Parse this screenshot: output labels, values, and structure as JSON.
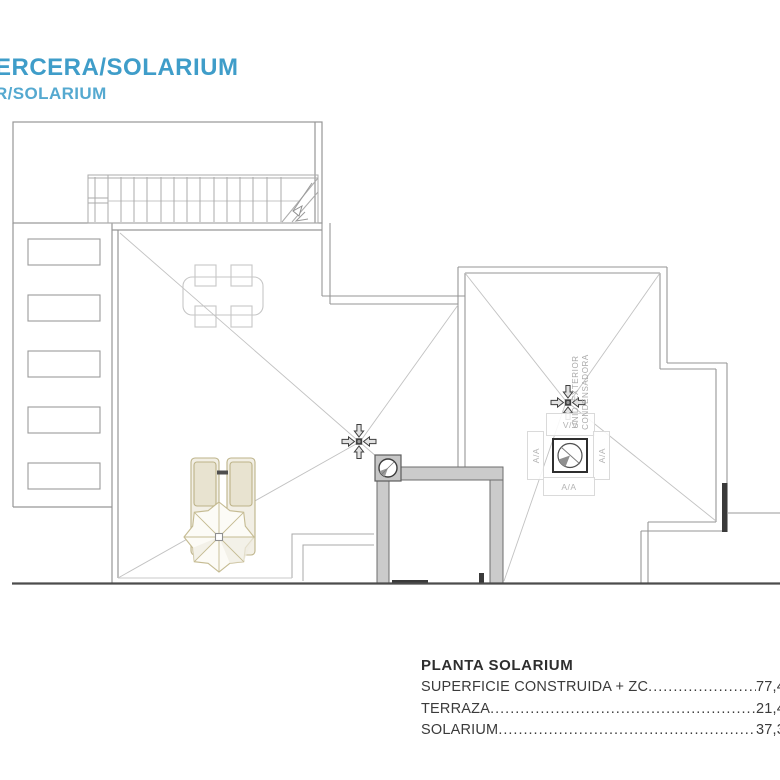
{
  "title": {
    "line1": "ERCERA/SOLARIUM",
    "line2": "R/SOLARIUM",
    "color_line1": "#3f9dc9",
    "color_line2": "#55a9d0"
  },
  "plan": {
    "labels": {
      "ventilation": "V/V",
      "ac_left": "A/A",
      "ac_right": "A/A",
      "ac_bottom": "A/A",
      "unit_line1": "UNID. EXTERIOR",
      "unit_line2": "CONDENSADORA"
    },
    "symbols": [
      "drain-with-arrows-left-terrace",
      "drain-with-arrows-right-roof",
      "condenser-fan-unit",
      "roof-vent-circle",
      "staircase-with-direction-arrow",
      "dining-table-4-chairs",
      "two-sun-loungers",
      "parasol-umbrella"
    ],
    "line_color": "#9a9a9a",
    "roof_slope_color": "#c0c0c0",
    "wall_fill": "#cbcbcb",
    "furniture_color": "#c5bb92"
  },
  "summary": {
    "title": "PLANTA SOLARIUM",
    "rows": [
      {
        "label": "SUPERFICIE CONSTRUIDA + ZC",
        "value": "77,4"
      },
      {
        "label": "TERRAZA",
        "value": "21,4"
      },
      {
        "label": "SOLARIUM",
        "value": "37,3"
      }
    ]
  }
}
